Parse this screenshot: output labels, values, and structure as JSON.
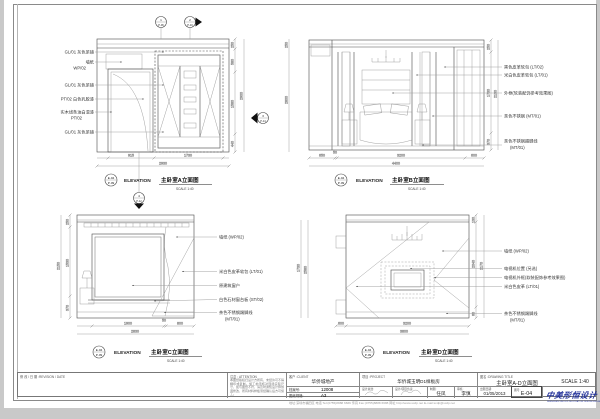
{
  "callouts": {
    "c1": {
      "n": "1",
      "ref": "P-06"
    },
    "c2": {
      "n": "2",
      "ref": "P-10"
    },
    "c3": {
      "n": "3",
      "ref": "P-14"
    },
    "c4": {
      "n": "4",
      "ref": "P-12"
    }
  },
  "elevA": {
    "tag": "E-04",
    "tag2": "P-09",
    "elev_label": "ELEVATION",
    "title": "主卧室A立面图",
    "scale": "SCALE 1:40",
    "labels": [
      "GL/01 灰色茶镜",
      "墙纸",
      "WP/02",
      "GL/01 灰色茶镜",
      "PT/02 白色乳胶漆",
      "实木线条油白混漆",
      "PT/02",
      "GL/01 灰色茶镜"
    ],
    "dim_b1": "915",
    "dim_b2": "1730",
    "dim_bt": "2930",
    "dim_r1": "250",
    "dim_r2": "580",
    "dim_r3": "1580",
    "dim_r4": "440",
    "dim_rt": "2900",
    "dim_aux1": "250",
    "dim_aux2": "2800"
  },
  "elevB": {
    "tag": "E-04",
    "tag2": "P-09",
    "elev_label": "ELEVATION",
    "title": "主卧室B立面图",
    "scale": "SCALE 1:40",
    "labels": [
      "黑色皮革软包 (LT/02)",
      "米白色皮革软包 (LT/01)",
      "外框(软装配饰参考效果图)",
      "茶色不锈钢 (MT/01)",
      "茶色不锈钢踢脚线",
      "(MT/01)"
    ],
    "dim_b1": "650",
    "dim_b2": "50",
    "dim_b3": "3200",
    "dim_b4": "600",
    "dim_bt": "4400",
    "dim_r1": "250",
    "dim_r2": "1730",
    "dim_r3": "370",
    "dim_rt": "2130"
  },
  "elevC": {
    "tag": "E-04",
    "tag2": "P-09",
    "elev_label": "ELEVATION",
    "title": "主卧室C立面图",
    "scale": "SCALE 1:40",
    "labels": [
      "墙纸 (WP/02)",
      "米白色皮革软包 (LT/01)",
      "原建筑窗户",
      "白色石材窗台板 (ST/02)",
      "茶色不锈钢踢脚线",
      "(MT/01)"
    ],
    "dim_b1": "1900",
    "dim_b2": "50",
    "dim_b3": "800",
    "dim_bt": "2830",
    "dim_l1": "250",
    "dim_l2": "1530",
    "dim_l3": "370",
    "dim_lt": "2150",
    "dim_aux1": "1730",
    "dim_aux2": "2580"
  },
  "elevD": {
    "tag": "E-04",
    "tag2": "P-09",
    "elev_label": "ELEVATION",
    "title": "主卧室D立面图",
    "scale": "SCALE 1:40",
    "labels": [
      "墙纸 (WP/02)",
      "电视机位置 (另选)",
      "电视机外框(软装配饰参考效果图)",
      "米白色皮革 (LT/01)",
      "茶色不锈钢踢脚线",
      "(MT/01)"
    ],
    "dim_b1": "600",
    "dim_b2": "3200",
    "dim_bt": "3800",
    "dim_r1": "130",
    "dim_r2": "2040",
    "dim_r3": "60",
    "dim_rt": "2170"
  },
  "titleblock": {
    "revision_label": "修 改 / 日 期 :REVISION / DATE",
    "attention_label": "注意 : ATTENTION",
    "attention_text": "本图纸版权归设计方所有，未经许可不得翻印或复制。施工前须核对现场实际尺寸，如与图纸不符，请及时通知设计师协调修改，所有材料样板须经确认后方可施工。",
    "client_label": "客户 :CLIENT",
    "client": "华侨城地产",
    "project_label": "项目 :PROJECT",
    "project": "华侨城玉明D1样板房",
    "file_label": "档案号:",
    "file_no": "12008",
    "paper_label": "图纸规格:",
    "paper": "A3",
    "director_label": "设计总监:",
    "lead_label": "设计/项目负责:",
    "draft_label": "制图:",
    "draft": "任凤",
    "check_label": "审核:",
    "check": "李慎",
    "date_label": "出图日期:",
    "date": "01/05/2013",
    "no_label": "图号:",
    "no": "E-04",
    "title_label": "图名 :DRAWING TITLE",
    "title": "主卧室A-D立面图",
    "scale": "SCALE 1:40",
    "logo": "中美形恒设计",
    "logo_sub": "SHENZHEN SINO-US DECORATION DESIGN ENGINEERING CO.,LTD",
    "footer": "地址:深圳市福田区 电话 Tel:(0755)8888 6666 传真 Fax:(0755)8888 6688 网址 http://www.scdp.net E-mail:scdp@scdp.net"
  }
}
